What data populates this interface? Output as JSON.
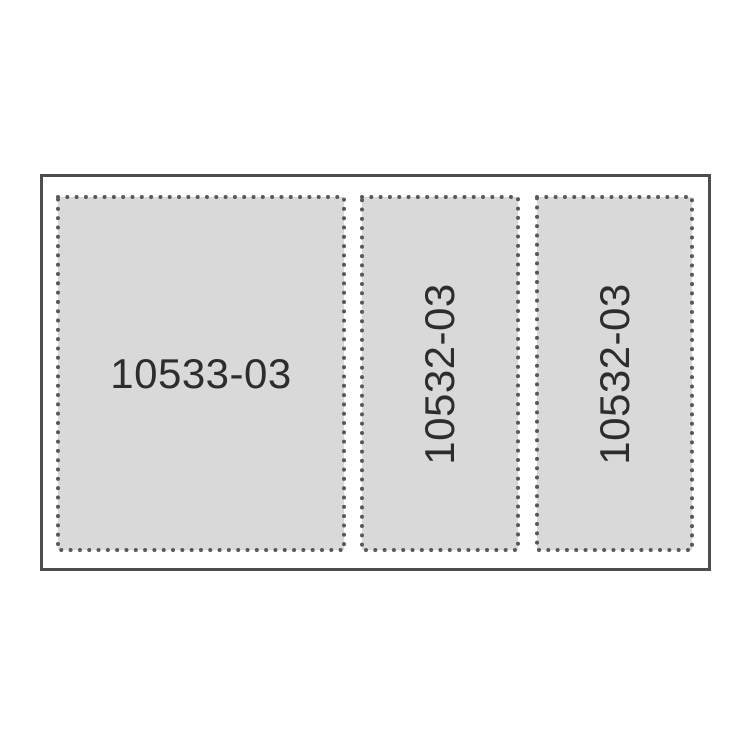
{
  "sheet": {
    "labels": [
      "10533-03",
      "10532-03",
      "10532-03"
    ],
    "colors": {
      "background": "#ffffff",
      "outline": "#4d4d4f",
      "panel_fill": "#d9d9da",
      "perforation_dots": "#58585a",
      "text": "#2d2d2f"
    }
  }
}
